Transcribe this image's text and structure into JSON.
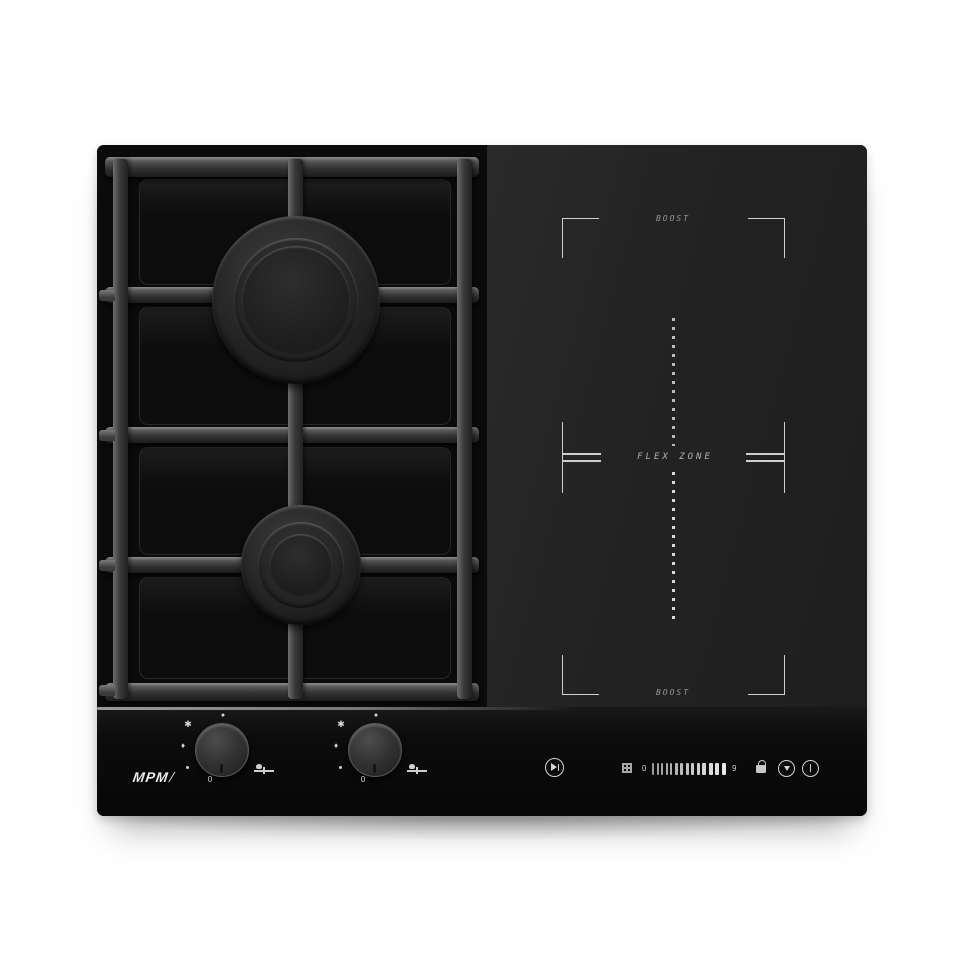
{
  "branding": {
    "logo_text": "MPM",
    "logo_slash": "/"
  },
  "induction_zone": {
    "boost_top_label": "BOOST",
    "flex_zone_label": "FLEX ZONE",
    "boost_bottom_label": "BOOST"
  },
  "touch_panel": {
    "slider": {
      "min_label": "0",
      "max_label": "9",
      "segment_count": 14
    },
    "icons": {
      "pause_play": "pause-play-icon",
      "grid": "grid-icon",
      "lock": "lock-icon",
      "timer": "timer-icon",
      "power": "power-icon"
    }
  },
  "knob_marks": {
    "max_dot": "●",
    "spark": "✱",
    "drop": "♦",
    "off": "0"
  },
  "colors": {
    "background": "#ffffff",
    "glass": "#1f1f1f",
    "marking": "#cfcfcf",
    "grate_highlight": "#8d8d8d"
  }
}
